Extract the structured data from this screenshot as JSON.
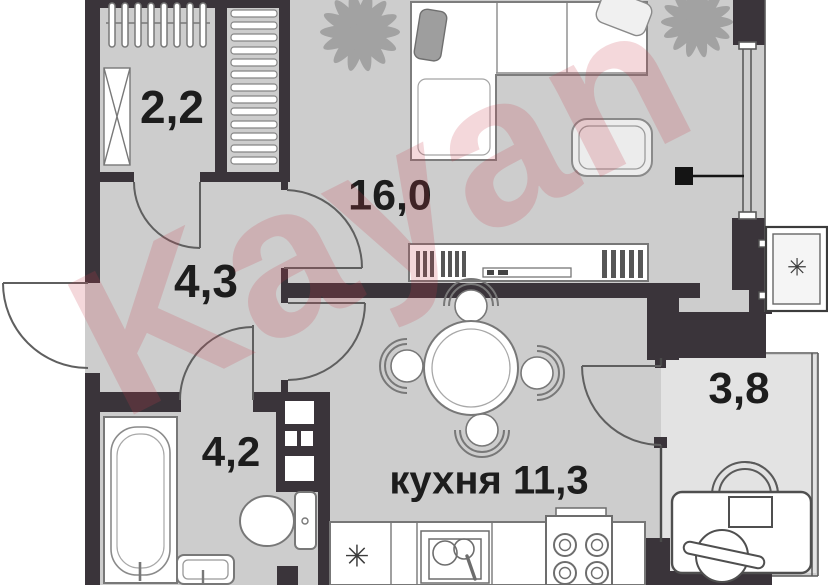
{
  "watermark": "Kayan",
  "rooms": {
    "wardrobe": {
      "area": "2,2"
    },
    "living": {
      "area": "16,0"
    },
    "hallway": {
      "area": "4,3"
    },
    "bathroom": {
      "area": "4,2"
    },
    "kitchen": {
      "area": "кухня 11,3"
    },
    "balcony": {
      "area": "3,8"
    }
  },
  "symbols": {
    "fridge": "✳",
    "ac": "✳"
  },
  "colors": {
    "wall": "#3a343a",
    "floor": "#cdcdcd",
    "balcony_floor": "#e3e3e3",
    "watermark_tint": "#c93e4a"
  }
}
